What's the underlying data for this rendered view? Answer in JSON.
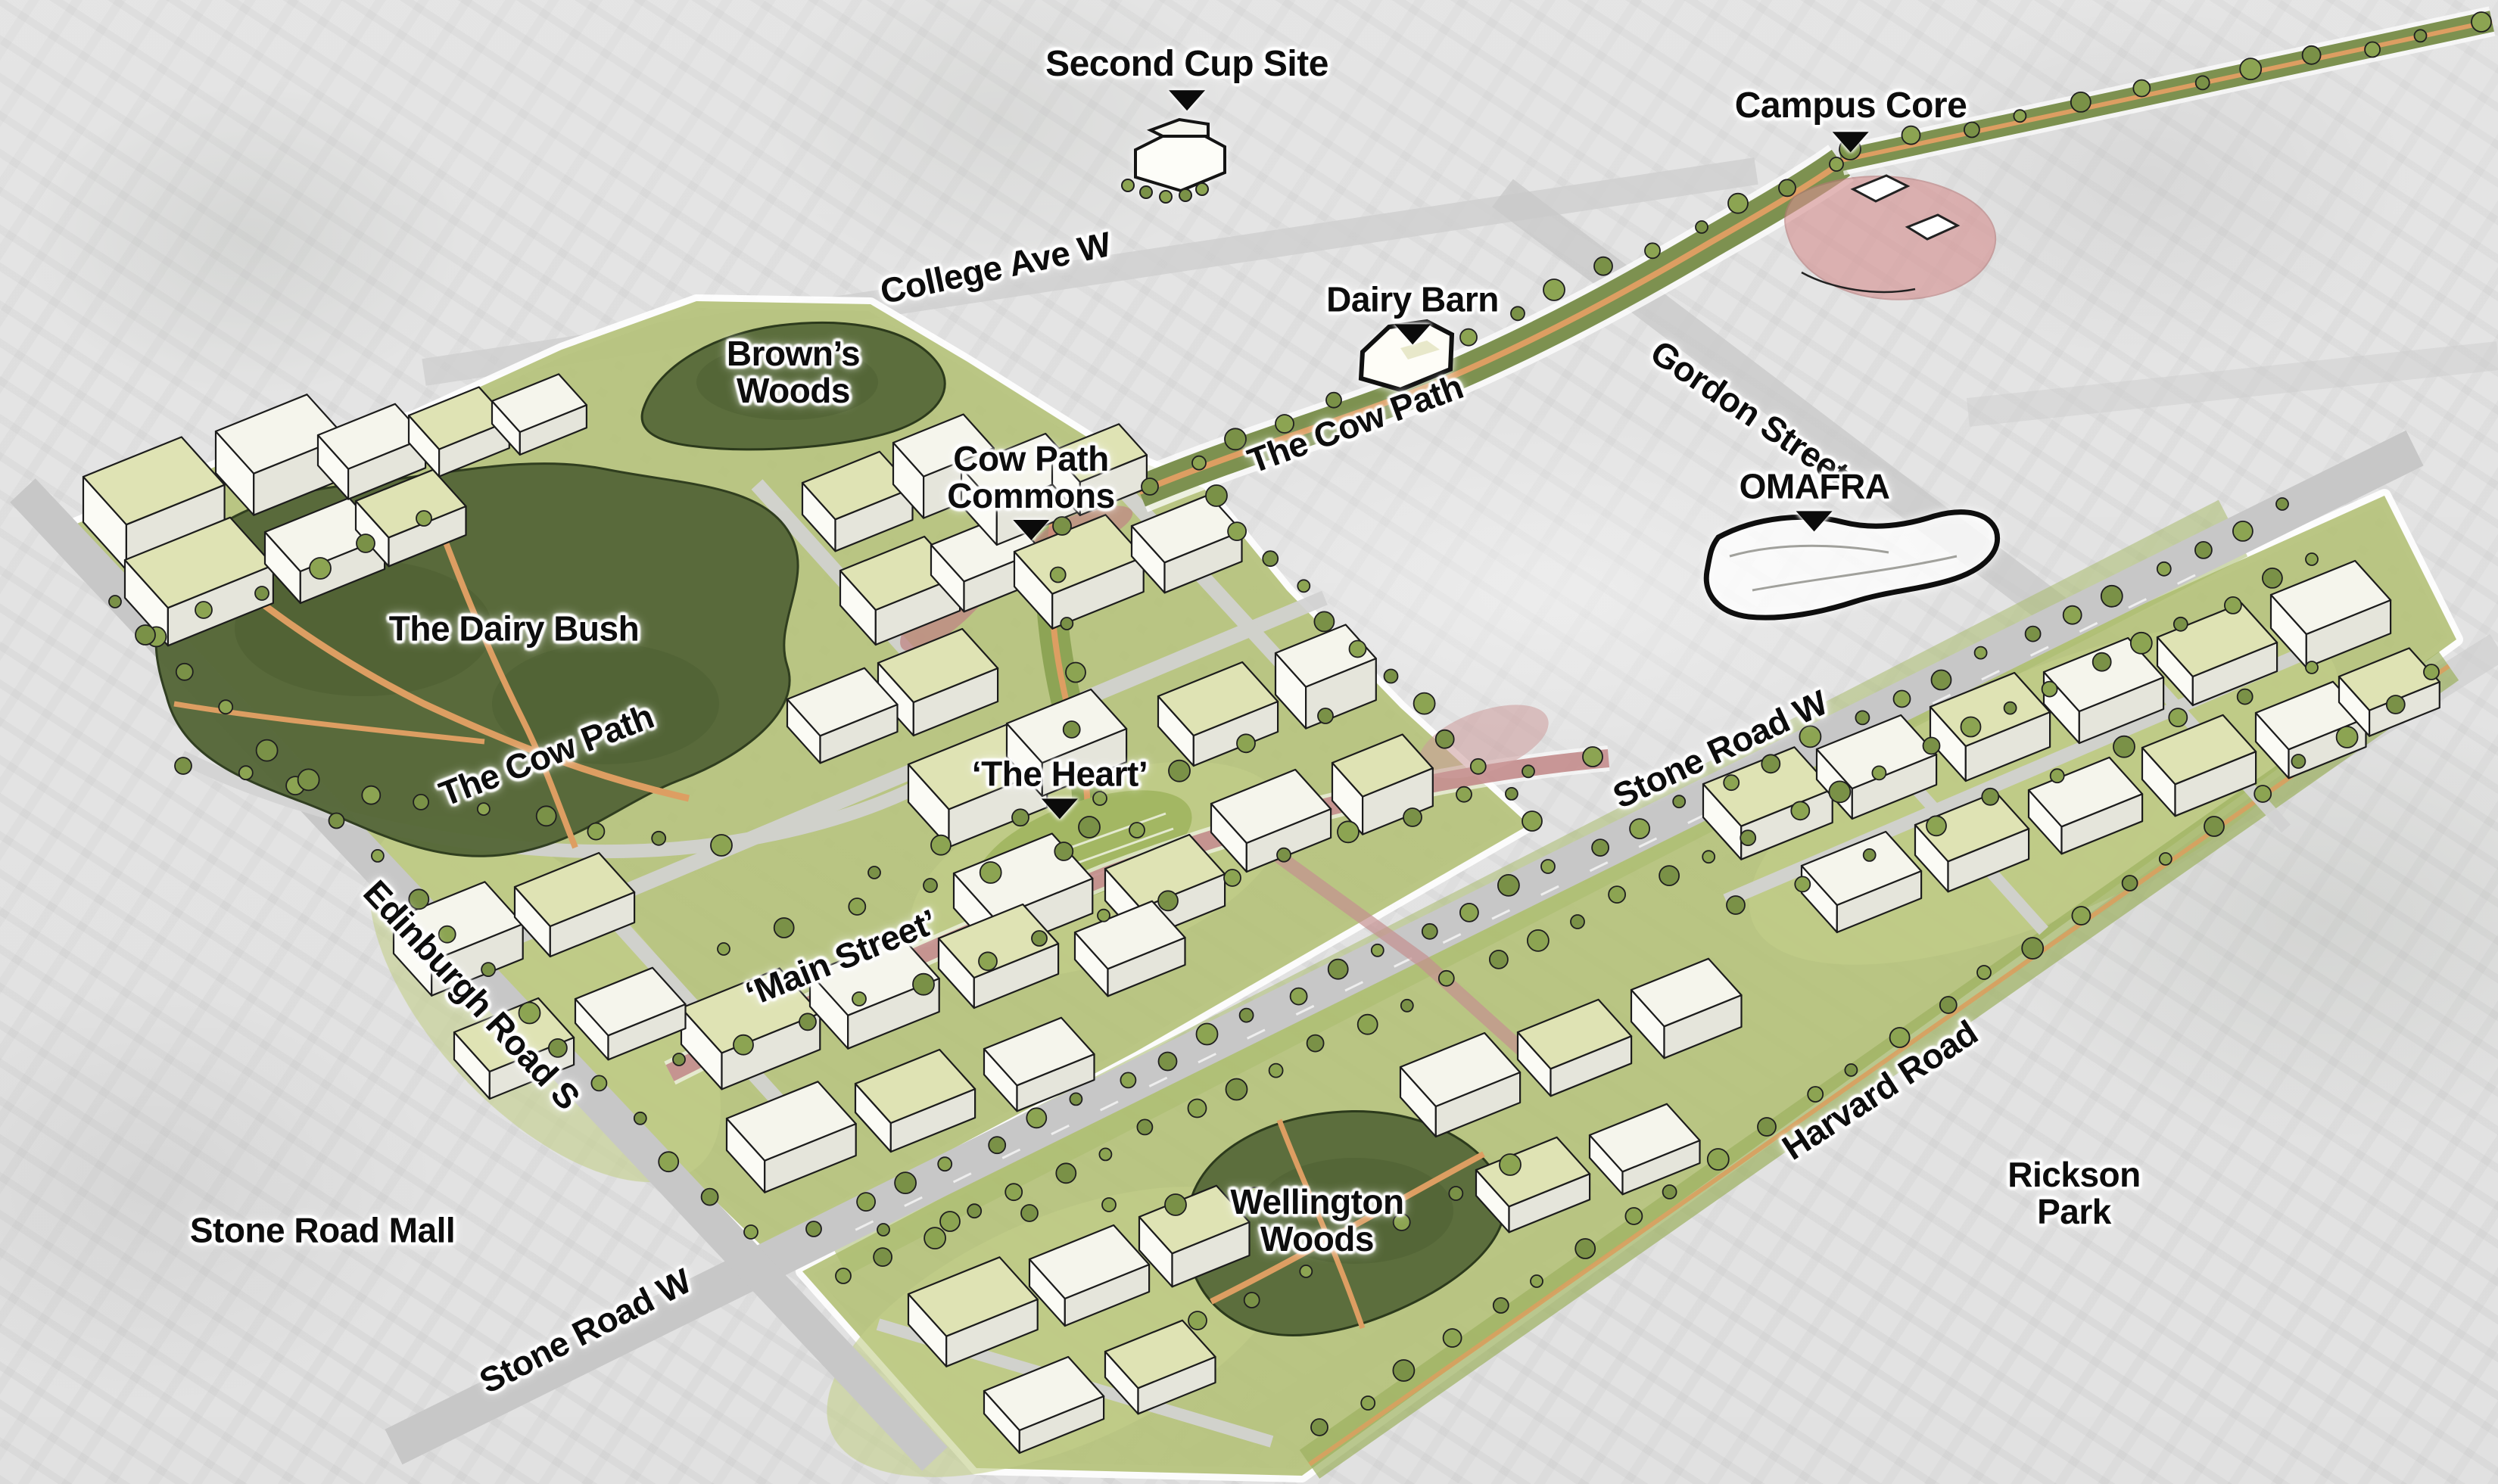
{
  "map": {
    "type": "campus-master-plan-illustration",
    "labels": {
      "second_cup_site": {
        "text": "Second Cup Site",
        "pointer": true
      },
      "campus_core": {
        "text": "Campus Core",
        "pointer": true
      },
      "college_ave_w": {
        "text": "College Ave W",
        "pointer": false
      },
      "dairy_barn": {
        "text": "Dairy Barn",
        "pointer": true
      },
      "gordon_street": {
        "text": "Gordon Street",
        "pointer": false
      },
      "cow_path_upper": {
        "text": "The Cow Path",
        "pointer": false
      },
      "browns_woods": {
        "text": "Brown’s\nWoods",
        "pointer": false
      },
      "cow_path_commons": {
        "text": "Cow Path\nCommons",
        "pointer": true
      },
      "omafra": {
        "text": "OMAFRA",
        "pointer": true
      },
      "dairy_bush": {
        "text": "The Dairy Bush",
        "pointer": false
      },
      "cow_path_lower": {
        "text": "The Cow Path",
        "pointer": false
      },
      "stone_road_w_upper": {
        "text": "Stone Road W",
        "pointer": false
      },
      "the_heart": {
        "text": "‘The Heart’",
        "pointer": true
      },
      "edinburgh_road_s": {
        "text": "Edinburgh Road S",
        "pointer": false
      },
      "main_street": {
        "text": "‘Main Street’",
        "pointer": false
      },
      "harvard_road": {
        "text": "Harvard Road",
        "pointer": false
      },
      "rickson_park": {
        "text": "Rickson\nPark",
        "pointer": false
      },
      "stone_road_mall": {
        "text": "Stone Road Mall",
        "pointer": false
      },
      "wellington_woods": {
        "text": "Wellington\nWoods",
        "pointer": false
      },
      "stone_road_w_lower": {
        "text": "Stone Road W",
        "pointer": false
      }
    },
    "palette": {
      "photo_gray": "#d7d7d7",
      "plan_green": "#b6c37d",
      "lawn_light": "#c3cf8a",
      "forest_green": "#5c6e3d",
      "forest_dark": "#4c5d32",
      "tree_green": "#8ca452",
      "tree_green_alt": "#7a9147",
      "corridor_green": "#7d9150",
      "path_orange": "#dd9e62",
      "road_gray": "#c7c7c7",
      "street_gray": "#d2d2d2",
      "pink_street": "#bf8585",
      "pink_core": "#d69090",
      "roof_khaki": "#dfe3b4",
      "roof_white": "#f5f5ec",
      "building_front": "#fbfbf5",
      "building_side": "#e5e5db",
      "outline_ink": "#1c1c1c",
      "label_text": "#0d0d0d",
      "label_halo": "#ffffff"
    }
  }
}
